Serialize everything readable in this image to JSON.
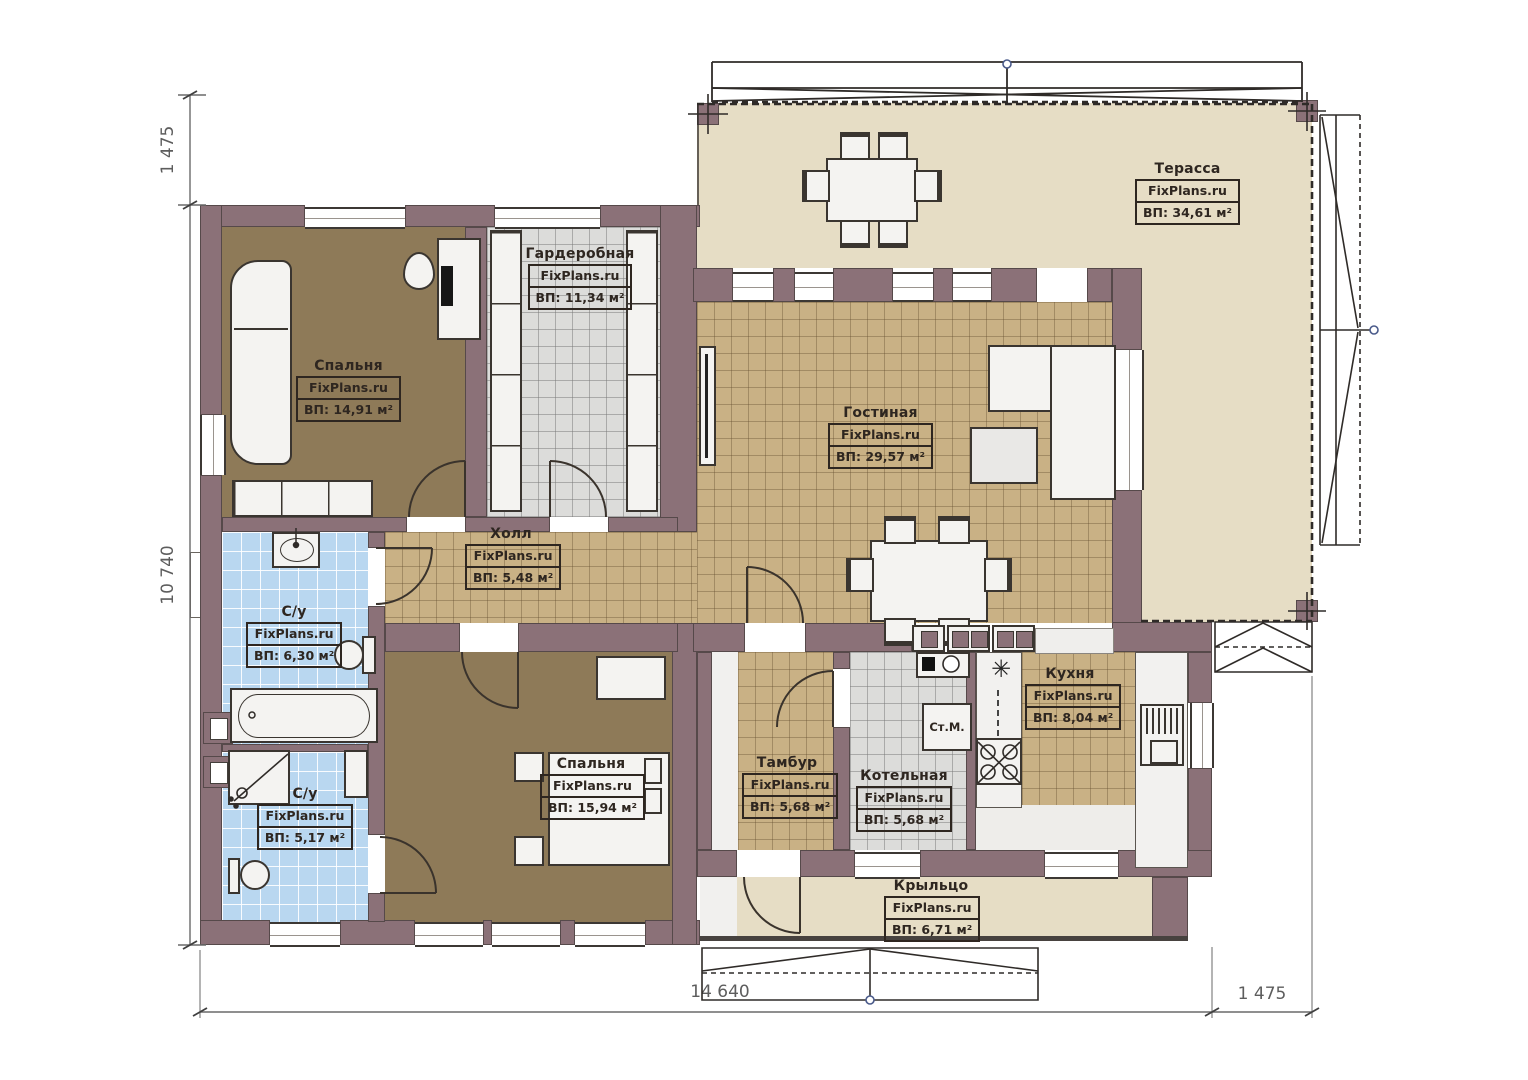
{
  "brand": "FixPlans.ru",
  "rooms": [
    {
      "id": "terrace",
      "name": "Терасса",
      "area": "ВП: 34,61 м²"
    },
    {
      "id": "bedroom-1",
      "name": "Спальня",
      "area": "ВП: 14,91 м²"
    },
    {
      "id": "wardrobe",
      "name": "Гардеробная",
      "area": "ВП: 11,34 м²"
    },
    {
      "id": "living-room",
      "name": "Гостиная",
      "area": "ВП: 29,57 м²"
    },
    {
      "id": "hall",
      "name": "Холл",
      "area": "ВП: 5,48 м²"
    },
    {
      "id": "bathroom-1",
      "name": "С/у",
      "area": "ВП: 6,30 м²"
    },
    {
      "id": "bathroom-2",
      "name": "С/у",
      "area": "ВП: 5,17 м²"
    },
    {
      "id": "bedroom-2",
      "name": "Спальня",
      "area": "ВП: 15,94 м²"
    },
    {
      "id": "vestibule",
      "name": "Тамбур",
      "area": "ВП: 5,68 м²"
    },
    {
      "id": "boiler-room",
      "name": "Котельная",
      "area": "ВП: 5,68 м²"
    },
    {
      "id": "kitchen",
      "name": "Кухня",
      "area": "ВП: 8,04 м²"
    },
    {
      "id": "porch",
      "name": "Крыльцо",
      "area": "ВП: 6,71 м²"
    }
  ],
  "dimensions": {
    "left_top": "1 475",
    "left_main": "10 740",
    "bottom_main": "14 640",
    "bottom_right": "1 475"
  },
  "appliances": {
    "washing_machine": "Ст.М."
  },
  "icons": {
    "kitchen_star": "✳"
  },
  "colors": {
    "wall": "#8b7178",
    "tile_tan": "#c9b185",
    "tile_blue": "#b9d7f0",
    "tile_gray": "#dcdcda",
    "terrace": "#e6ddc5",
    "floor_brown": "#8e7a58"
  }
}
